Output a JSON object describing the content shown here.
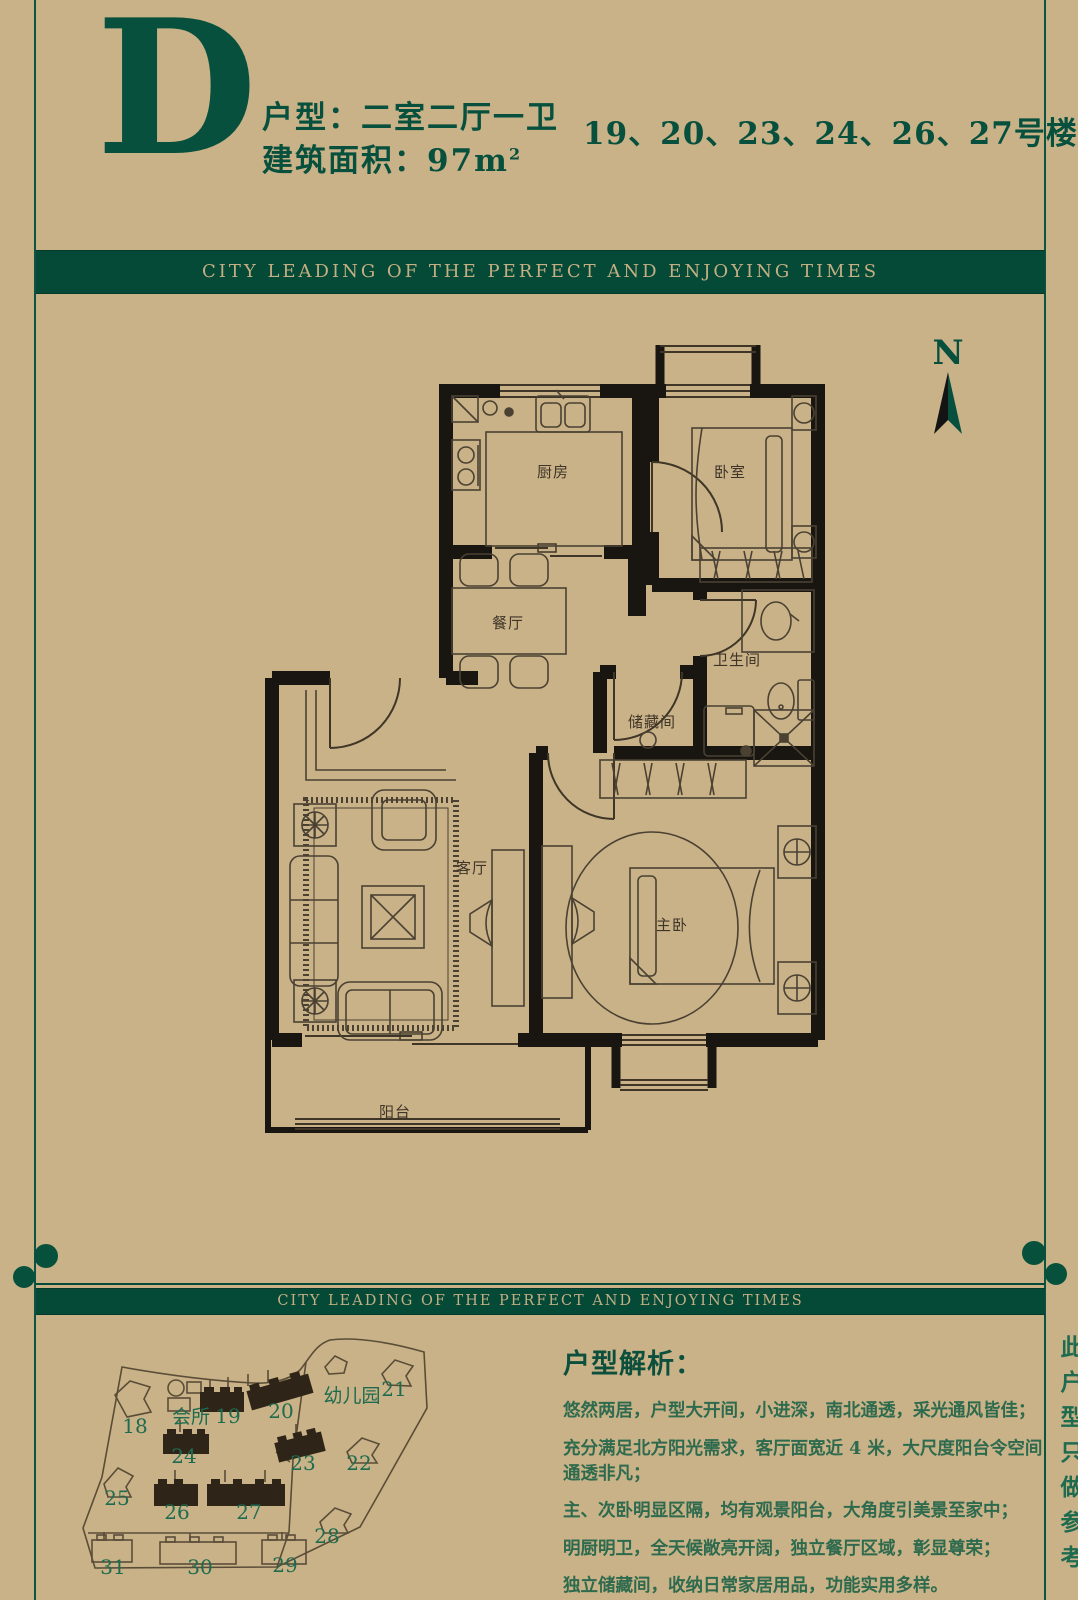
{
  "header": {
    "letter": "D",
    "type_line": "户型：二室二厅一卫",
    "area_label": "建筑面积：",
    "area_value": "97m",
    "area_sup": "2",
    "buildings_line": "19、20、23、24、26、27号楼"
  },
  "banner": {
    "text": "CITY LEADING OF THE PERFECT AND ENJOYING TIMES"
  },
  "plan": {
    "compass": "N",
    "rooms": {
      "kitchen": "厨房",
      "bedroom": "卧室",
      "dining": "餐厅",
      "bathroom": "卫生间",
      "storage": "储藏间",
      "living": "客厅",
      "master": "主卧",
      "balcony": "阳台"
    }
  },
  "sitemap": {
    "clubhouse": "会所",
    "kindergarten": "幼儿园",
    "highlighted": [
      "19",
      "20",
      "23",
      "24",
      "26",
      "27"
    ],
    "numbers": {
      "b18": "18",
      "b19": "19",
      "b20": "20",
      "b21": "21",
      "b22": "22",
      "b23": "23",
      "b24": "24",
      "b25": "25",
      "b26": "26",
      "b27": "27",
      "b28": "28",
      "b29": "29",
      "b30": "30",
      "b31": "31"
    }
  },
  "analysis": {
    "heading": "户型解析：",
    "lines": [
      "悠然两居，户型大开间，小进深，南北通透，采光通风皆佳；",
      "充分满足北方阳光需求，客厅面宽近 4 米，大尺度阳台令空间通透非凡；",
      "主、次卧明显区隔，均有观景阳台，大角度引美景至家中；",
      "明厨明卫，全天候敞亮开阔，独立餐厅区域，彰显尊荣；",
      "独立储藏间，收纳日常家居用品，功能实用多样。"
    ]
  },
  "side_note": "此户型只做参考",
  "colors": {
    "green": "#07503c",
    "tan": "#c9b287",
    "wall": "#191510"
  }
}
